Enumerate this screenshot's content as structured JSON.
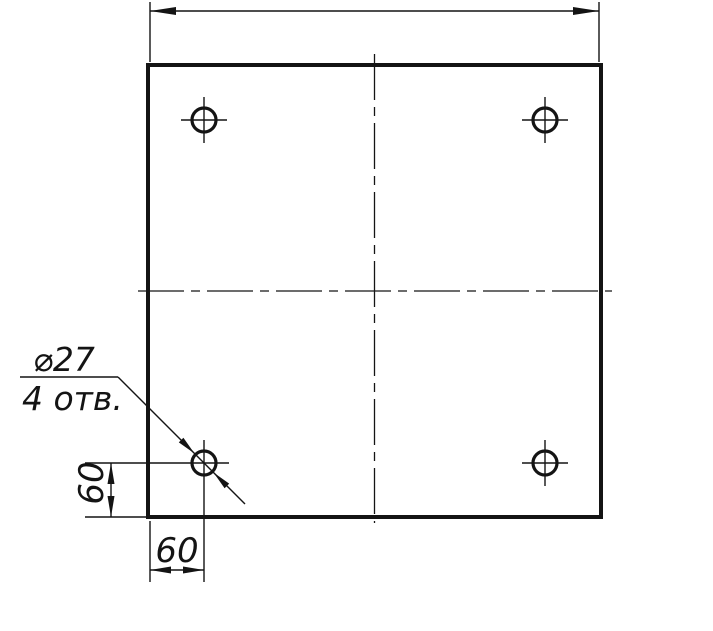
{
  "drawing": {
    "callout": {
      "diameter_label": "⌀27",
      "holes_label": "4 отв."
    },
    "dimensions": {
      "hole_offset_vertical": "60",
      "hole_offset_horizontal": "60"
    },
    "colors": {
      "ink": "#141414",
      "paper": "#ffffff"
    }
  }
}
